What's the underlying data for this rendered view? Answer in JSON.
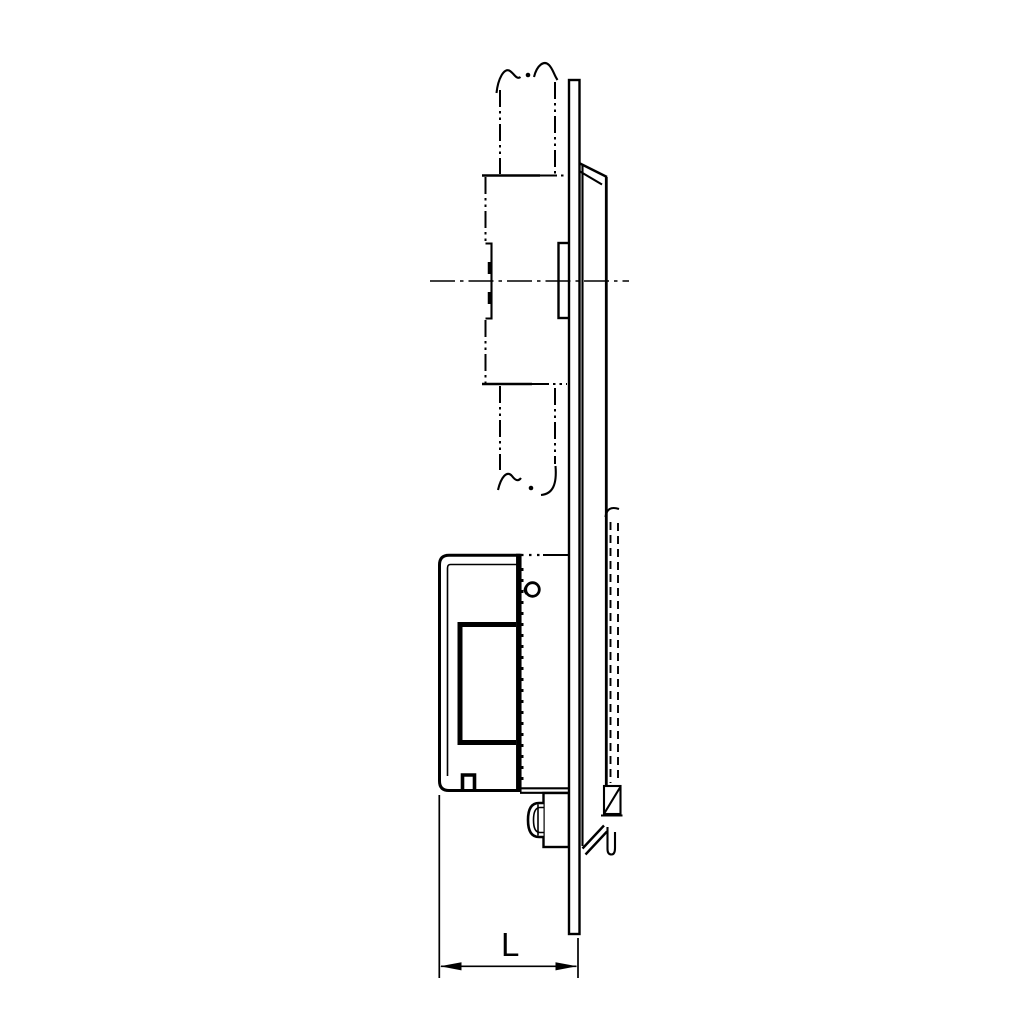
{
  "drawing": {
    "dimension_label": "L",
    "line_color": "#000000",
    "background_color": "#ffffff"
  }
}
